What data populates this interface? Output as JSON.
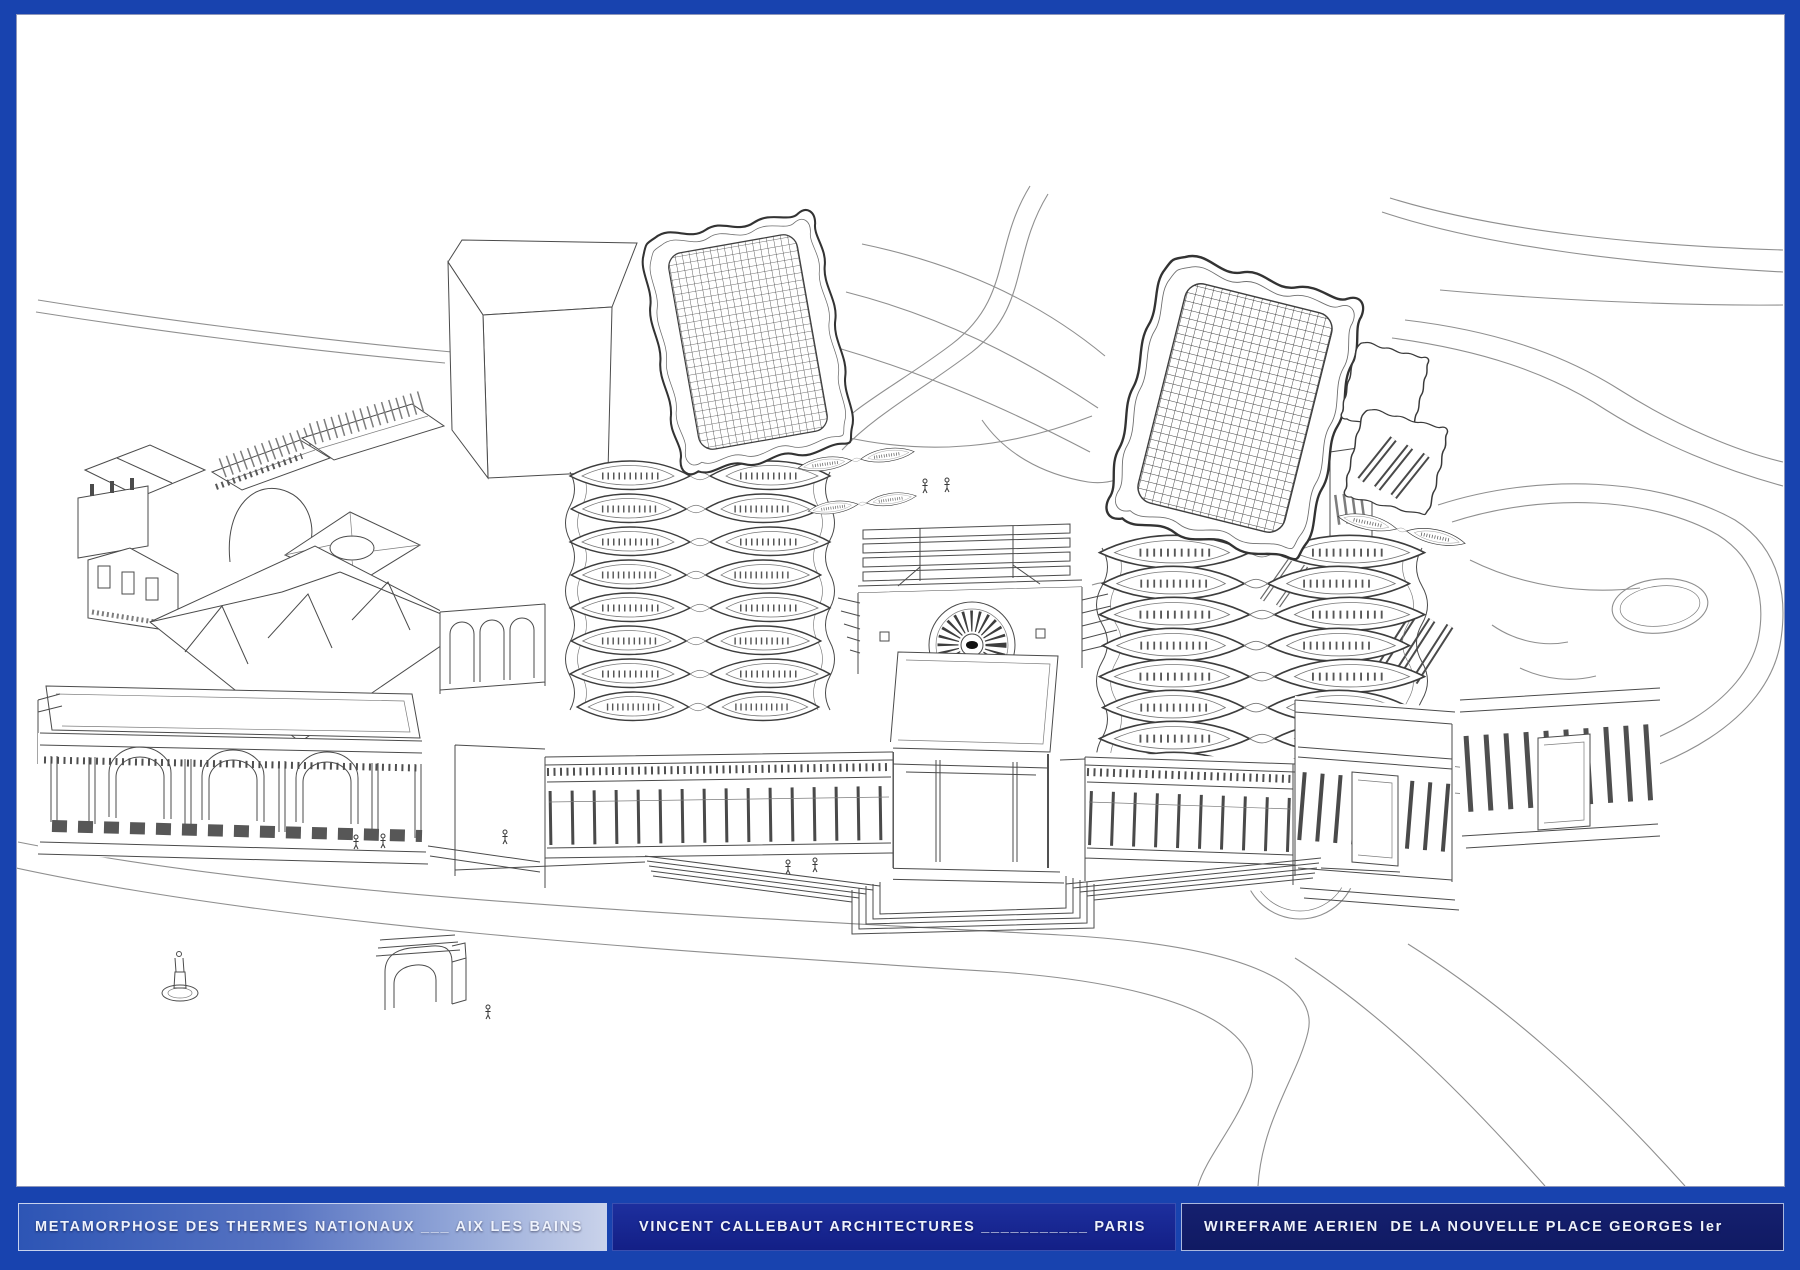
{
  "window": {
    "background": "#1843af"
  },
  "title_bar": {
    "height_px": 48,
    "text_color": "#eef2fc",
    "panels": [
      {
        "id": "project",
        "label": "METAMORPHOSE DES THERMES NATIONAUX ___ AIX LES BAINS"
      },
      {
        "id": "architect",
        "label": "VINCENT CALLEBAUT ARCHITECTURES ___________ PARIS"
      },
      {
        "id": "view",
        "label": "WIREFRAME AERIEN  DE LA NOUVELLE PLACE GEORGES Ier"
      }
    ]
  },
  "drawing": {
    "kind": "architectural wireframe aerial perspective",
    "canvas_color": "#ffffff",
    "line_color": "#4b4b4b",
    "road_line_color": "#8f8f8f"
  }
}
